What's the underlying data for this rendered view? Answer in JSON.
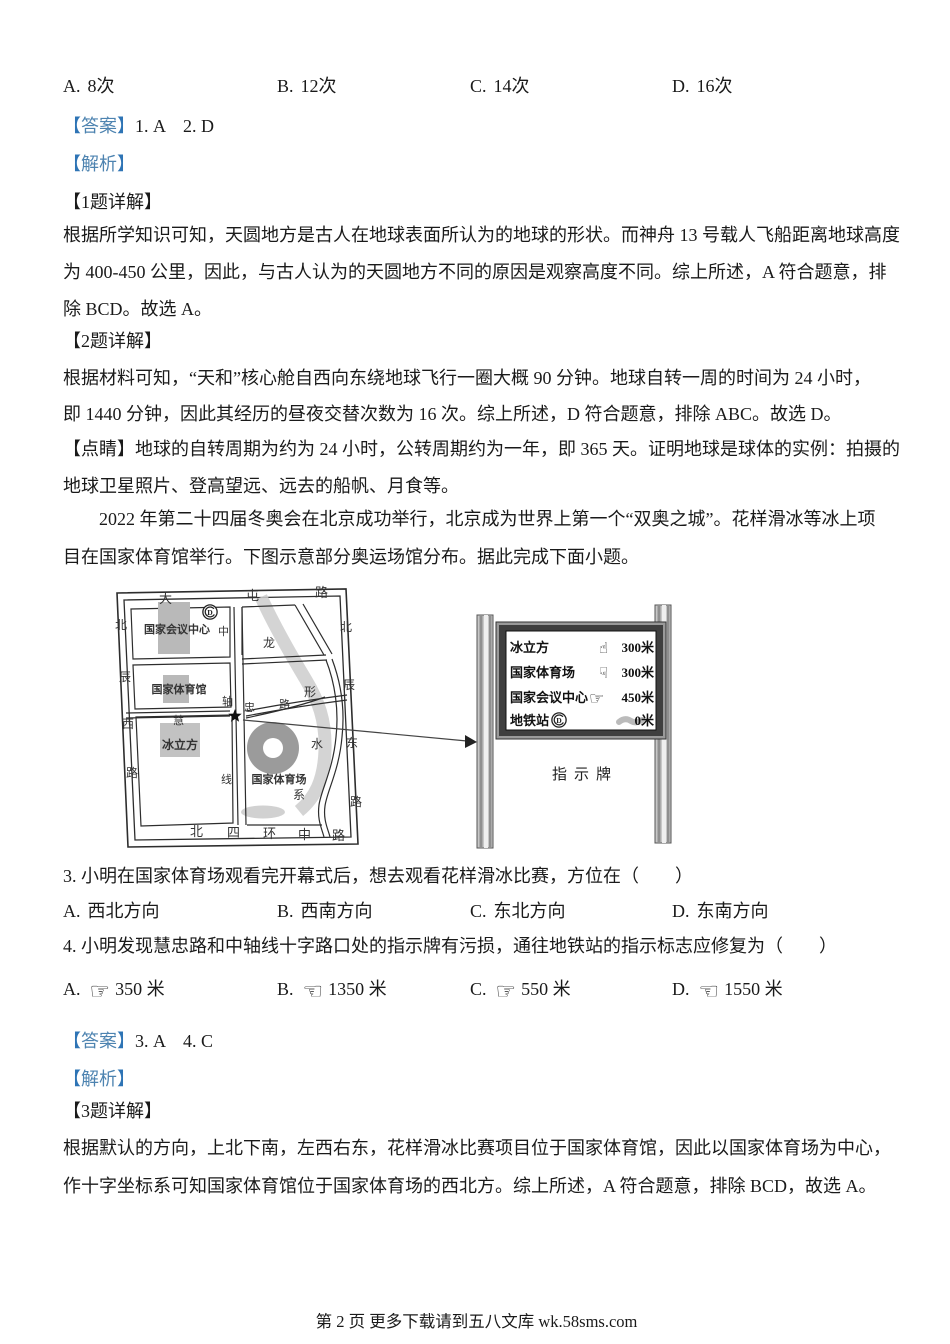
{
  "colors": {
    "bracket_blue": "#2e74b5",
    "word_blue": "#4d83b0"
  },
  "q12_options": [
    {
      "key": "A.",
      "text": "8次"
    },
    {
      "key": "B.",
      "text": "12次"
    },
    {
      "key": "C.",
      "text": "14次"
    },
    {
      "key": "D.",
      "text": "16次"
    }
  ],
  "ans12": {
    "open": "【",
    "word": "答案",
    "close": "】",
    "value": "1. A    2. D"
  },
  "jiexi": {
    "open": "【",
    "word": "解析",
    "close": "】"
  },
  "detail1": "【1题详解】",
  "p1": [
    "根据所学知识可知，天圆地方是古人在地球表面所认为的地球的形状。而神舟 13 号载人飞船距离地球高度",
    "为 400-450 公里，因此，与古人认为的天圆地方不同的原因是观察高度不同。综上所述，A 符合题意，排",
    "除 BCD。故选 A。"
  ],
  "detail2": "【2题详解】",
  "p2": [
    "根据材料可知，“天和”核心舱自西向东绕地球飞行一圈大概 90 分钟。地球自转一周的时间为 24 小时，",
    "即 1440 分钟，因此其经历的昼夜交替次数为 16 次。综上所述，D 符合题意，排除 ABC。故选 D。"
  ],
  "dianjing": [
    "【点睛】地球的自转周期为约为 24 小时，公转周期约为一年，即 365 天。证明地球是球体的实例：拍摄的",
    "地球卫星照片、登高望远、远去的船帆、月食等。"
  ],
  "intro": [
    "2022 年第二十四届冬奥会在北京成功举行，北京成为世界上第一个“双奥之城”。花样滑冰等冰上项",
    "目在国家体育馆举行。下图示意部分奥运场馆分布。据此完成下面小题。"
  ],
  "map": {
    "roads": {
      "datun": [
        "大",
        "屯",
        "路"
      ],
      "beichen_west": [
        "北",
        "辰",
        "西",
        "路"
      ],
      "beichen_east": [
        "北",
        "辰",
        "东",
        "路"
      ],
      "sihuan": [
        "北",
        "四",
        "环",
        "中",
        "路"
      ],
      "zhongzhouxian": [
        "中",
        "轴",
        "线"
      ],
      "huizhong": [
        "慧",
        "忠",
        "路"
      ],
      "river": [
        "龙",
        "形",
        "水",
        "系"
      ]
    },
    "venues": {
      "conference": "国家会议中心",
      "gym": "国家体育馆",
      "cube": "冰立方",
      "stadium": "国家体育场"
    },
    "metro_letter": "D"
  },
  "sign": {
    "rows": [
      {
        "label": "冰立方",
        "glyph": "☝",
        "value": "300米"
      },
      {
        "label": "国家体育场",
        "glyph": "☟",
        "value": "300米"
      },
      {
        "label": "国家会议中心",
        "glyph": "☞",
        "value": "450米"
      },
      {
        "label": "地铁站",
        "glyph": "",
        "value": "0米"
      }
    ],
    "caption": "指示牌"
  },
  "q3": {
    "text": "3. 小明在国家体育场观看完开幕式后，想去观看花样滑冰比赛，方位在（　　）",
    "options": [
      {
        "key": "A.",
        "text": "西北方向"
      },
      {
        "key": "B.",
        "text": "西南方向"
      },
      {
        "key": "C.",
        "text": "东北方向"
      },
      {
        "key": "D.",
        "text": "东南方向"
      }
    ]
  },
  "q4": {
    "text": "4. 小明发现慧忠路和中轴线十字路口处的指示牌有污损，通往地铁站的指示标志应修复为（　　）",
    "options": [
      {
        "key": "A.",
        "glyph": "☞",
        "text": "350 米"
      },
      {
        "key": "B.",
        "glyph": "☜",
        "text": "1350 米"
      },
      {
        "key": "C.",
        "glyph": "☞",
        "text": "550 米"
      },
      {
        "key": "D.",
        "glyph": "☜",
        "text": "1550 米"
      }
    ]
  },
  "ans34": {
    "open": "【",
    "word": "答案",
    "close": "】",
    "value": "3. A    4. C"
  },
  "detail3": "【3题详解】",
  "p3": [
    "根据默认的方向，上北下南，左西右东，花样滑冰比赛项目位于国家体育馆，因此以国家体育场为中心，",
    "作十字坐标系可知国家体育馆位于国家体育场的西北方。综上所述，A 符合题意，排除 BCD，故选 A。"
  ],
  "footer": "第 2 页  更多下载请到五八文库 wk.58sms.com"
}
